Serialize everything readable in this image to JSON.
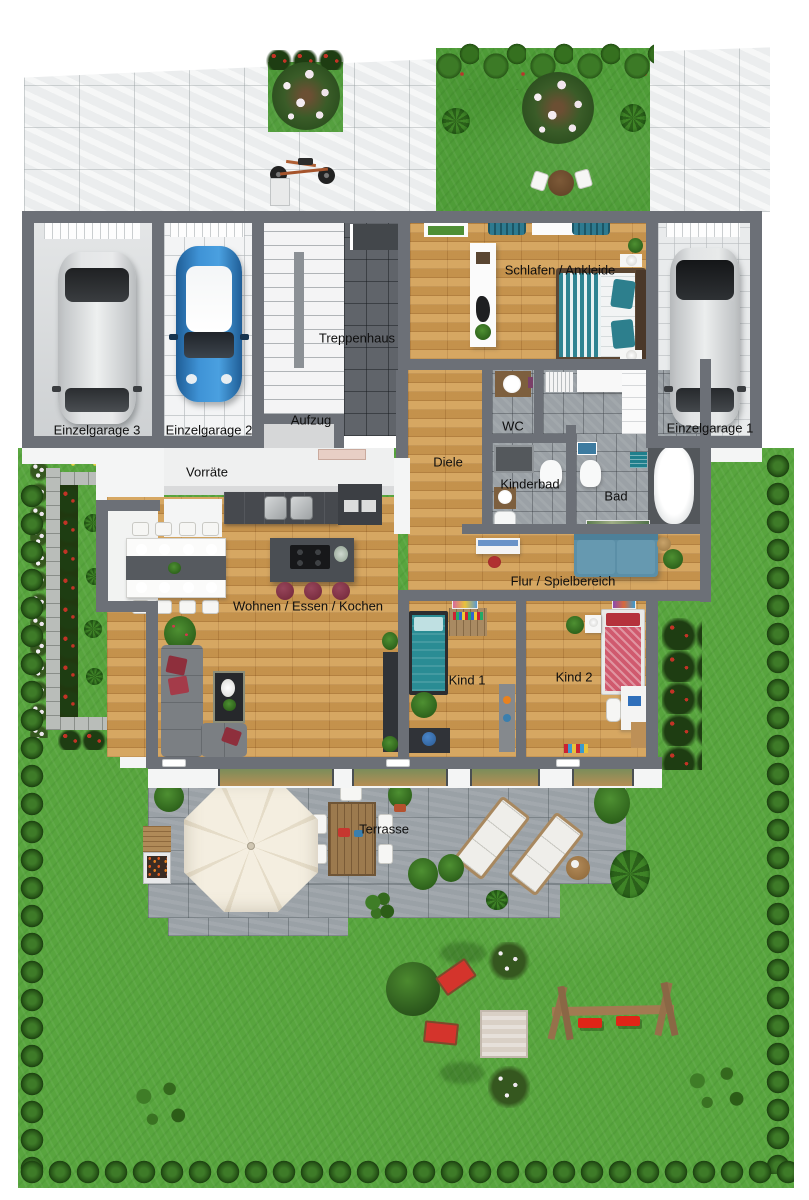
{
  "plan_type": "3d-floor-plan-top-view",
  "rooms": {
    "einzelgarage3": {
      "label": "Einzelgarage 3"
    },
    "einzelgarage2": {
      "label": "Einzelgarage 2"
    },
    "einzelgarage1": {
      "label": "Einzelgarage 1"
    },
    "treppenhaus": {
      "label": "Treppenhaus"
    },
    "aufzug": {
      "label": "Aufzug"
    },
    "schlafen": {
      "label": "Schlafen / Ankleide"
    },
    "wc": {
      "label": "WC"
    },
    "diele": {
      "label": "Diele"
    },
    "kinderbad": {
      "label": "Kinderbad"
    },
    "bad": {
      "label": "Bad"
    },
    "vorraete": {
      "label": "Vorräte"
    },
    "flur": {
      "label": "Flur / Spielbereich"
    },
    "wohnen": {
      "label": "Wohnen / Essen / Kochen"
    },
    "kind1": {
      "label": "Kind 1"
    },
    "kind2": {
      "label": "Kind 2"
    }
  },
  "outdoor": {
    "terrasse": {
      "label": "Terrasse"
    }
  },
  "objects_visible": [
    "silver-car-garage-3",
    "blue-mini-garage-2",
    "silver-car-garage-1",
    "staircase",
    "elevator",
    "double-bed-teal",
    "wardrobe-island",
    "dining-table-8-chairs",
    "kitchen-island-3-stools",
    "kitchen-counter-sinks",
    "corner-sofa-gray",
    "coffee-table",
    "tv-board",
    "play-sofa-blue",
    "bathtub",
    "toilets",
    "shower",
    "kid-bed-teal",
    "kid-bed-red",
    "desks",
    "parasol",
    "bbq-grill",
    "terrace-dining-set",
    "sun-loungers",
    "swing-set-red",
    "sandbox",
    "red-deck-chairs",
    "bicycle",
    "blossom-trees",
    "hedge-balls",
    "flower-bed"
  ],
  "colors": {
    "wall": "#6c7077",
    "wood_floor": "#cd9a52",
    "lawn": "#58a53e",
    "driveway_paver": "#ebedee",
    "terrace_paver": "#9aa1a6",
    "bath_tile": "#9ba1a6",
    "hedge": "#2b5c1a",
    "teal_accent": "#2e7f93",
    "flur_sofa_blue": "#5b8fa7",
    "stool_burgundy": "#7c2f42",
    "kid2_bed_red": "#d05a6e",
    "play_red": "#d4342c",
    "parasol_cream": "#f2ecdd"
  }
}
